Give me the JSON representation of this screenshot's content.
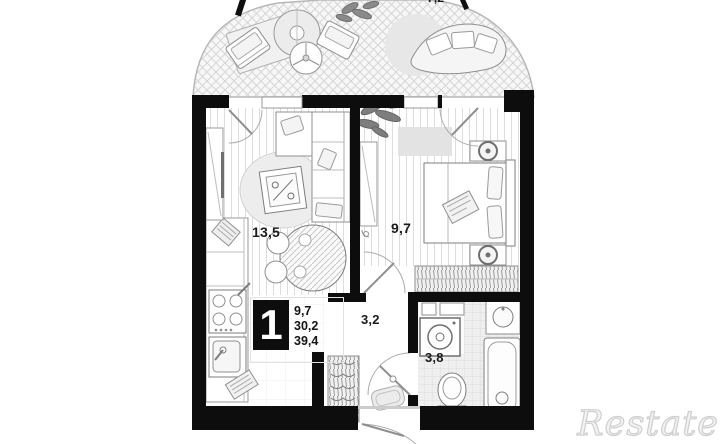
{
  "plan": {
    "type": "apartment-floor-plan",
    "rooms": {
      "balcony": {
        "area": "7,2",
        "floor": "crosshatch",
        "furniture": [
          "armchair-icon",
          "parasol-table-icon",
          "fan-table-icon",
          "armchair-icon",
          "round-rug-icon",
          "curved-sofa-icon",
          "plant-icon"
        ]
      },
      "living": {
        "area": "13,5",
        "floor": "plank-stripes",
        "furniture": [
          "tv-bench-icon",
          "oval-rug-icon",
          "coffee-table-icon",
          "corner-sofa-icon",
          "dining-table-icon",
          "chair-icon",
          "chair-icon"
        ]
      },
      "kitchen": {
        "floor": "plank-stripes",
        "furniture": [
          "counter-icon",
          "stove-icon",
          "kitchen-sink-icon",
          "decor-icon"
        ]
      },
      "bedroom": {
        "area": "9,7",
        "floor": "plank-stripes",
        "furniture": [
          "plant-icon",
          "rug-icon",
          "console-icon",
          "double-bed-icon",
          "nightstand-lamp-icon",
          "nightstand-lamp-icon",
          "wardrobe-icon",
          "door-arc"
        ]
      },
      "hall": {
        "area": "3,2",
        "floor": "plain",
        "furniture": [
          "coat-rack-icon",
          "doormat-icon",
          "entrance-door-arc"
        ]
      },
      "bathroom": {
        "area": "3,8",
        "floor": "tiles",
        "furniture": [
          "washing-machine-icon",
          "bath-sink-icon",
          "bathtub-icon",
          "toilet-icon",
          "door-arc"
        ]
      }
    },
    "info_block": {
      "rooms_count": "1",
      "values": [
        "9,7",
        "30,2",
        "39,4"
      ]
    },
    "colors": {
      "wall": "#0d0d0d",
      "label": "#1b1b1b",
      "floor_line": "#dddddd",
      "furniture_stroke": "#8f8f8f",
      "background": "#ffffff"
    }
  },
  "watermark": {
    "text": "Restate"
  }
}
